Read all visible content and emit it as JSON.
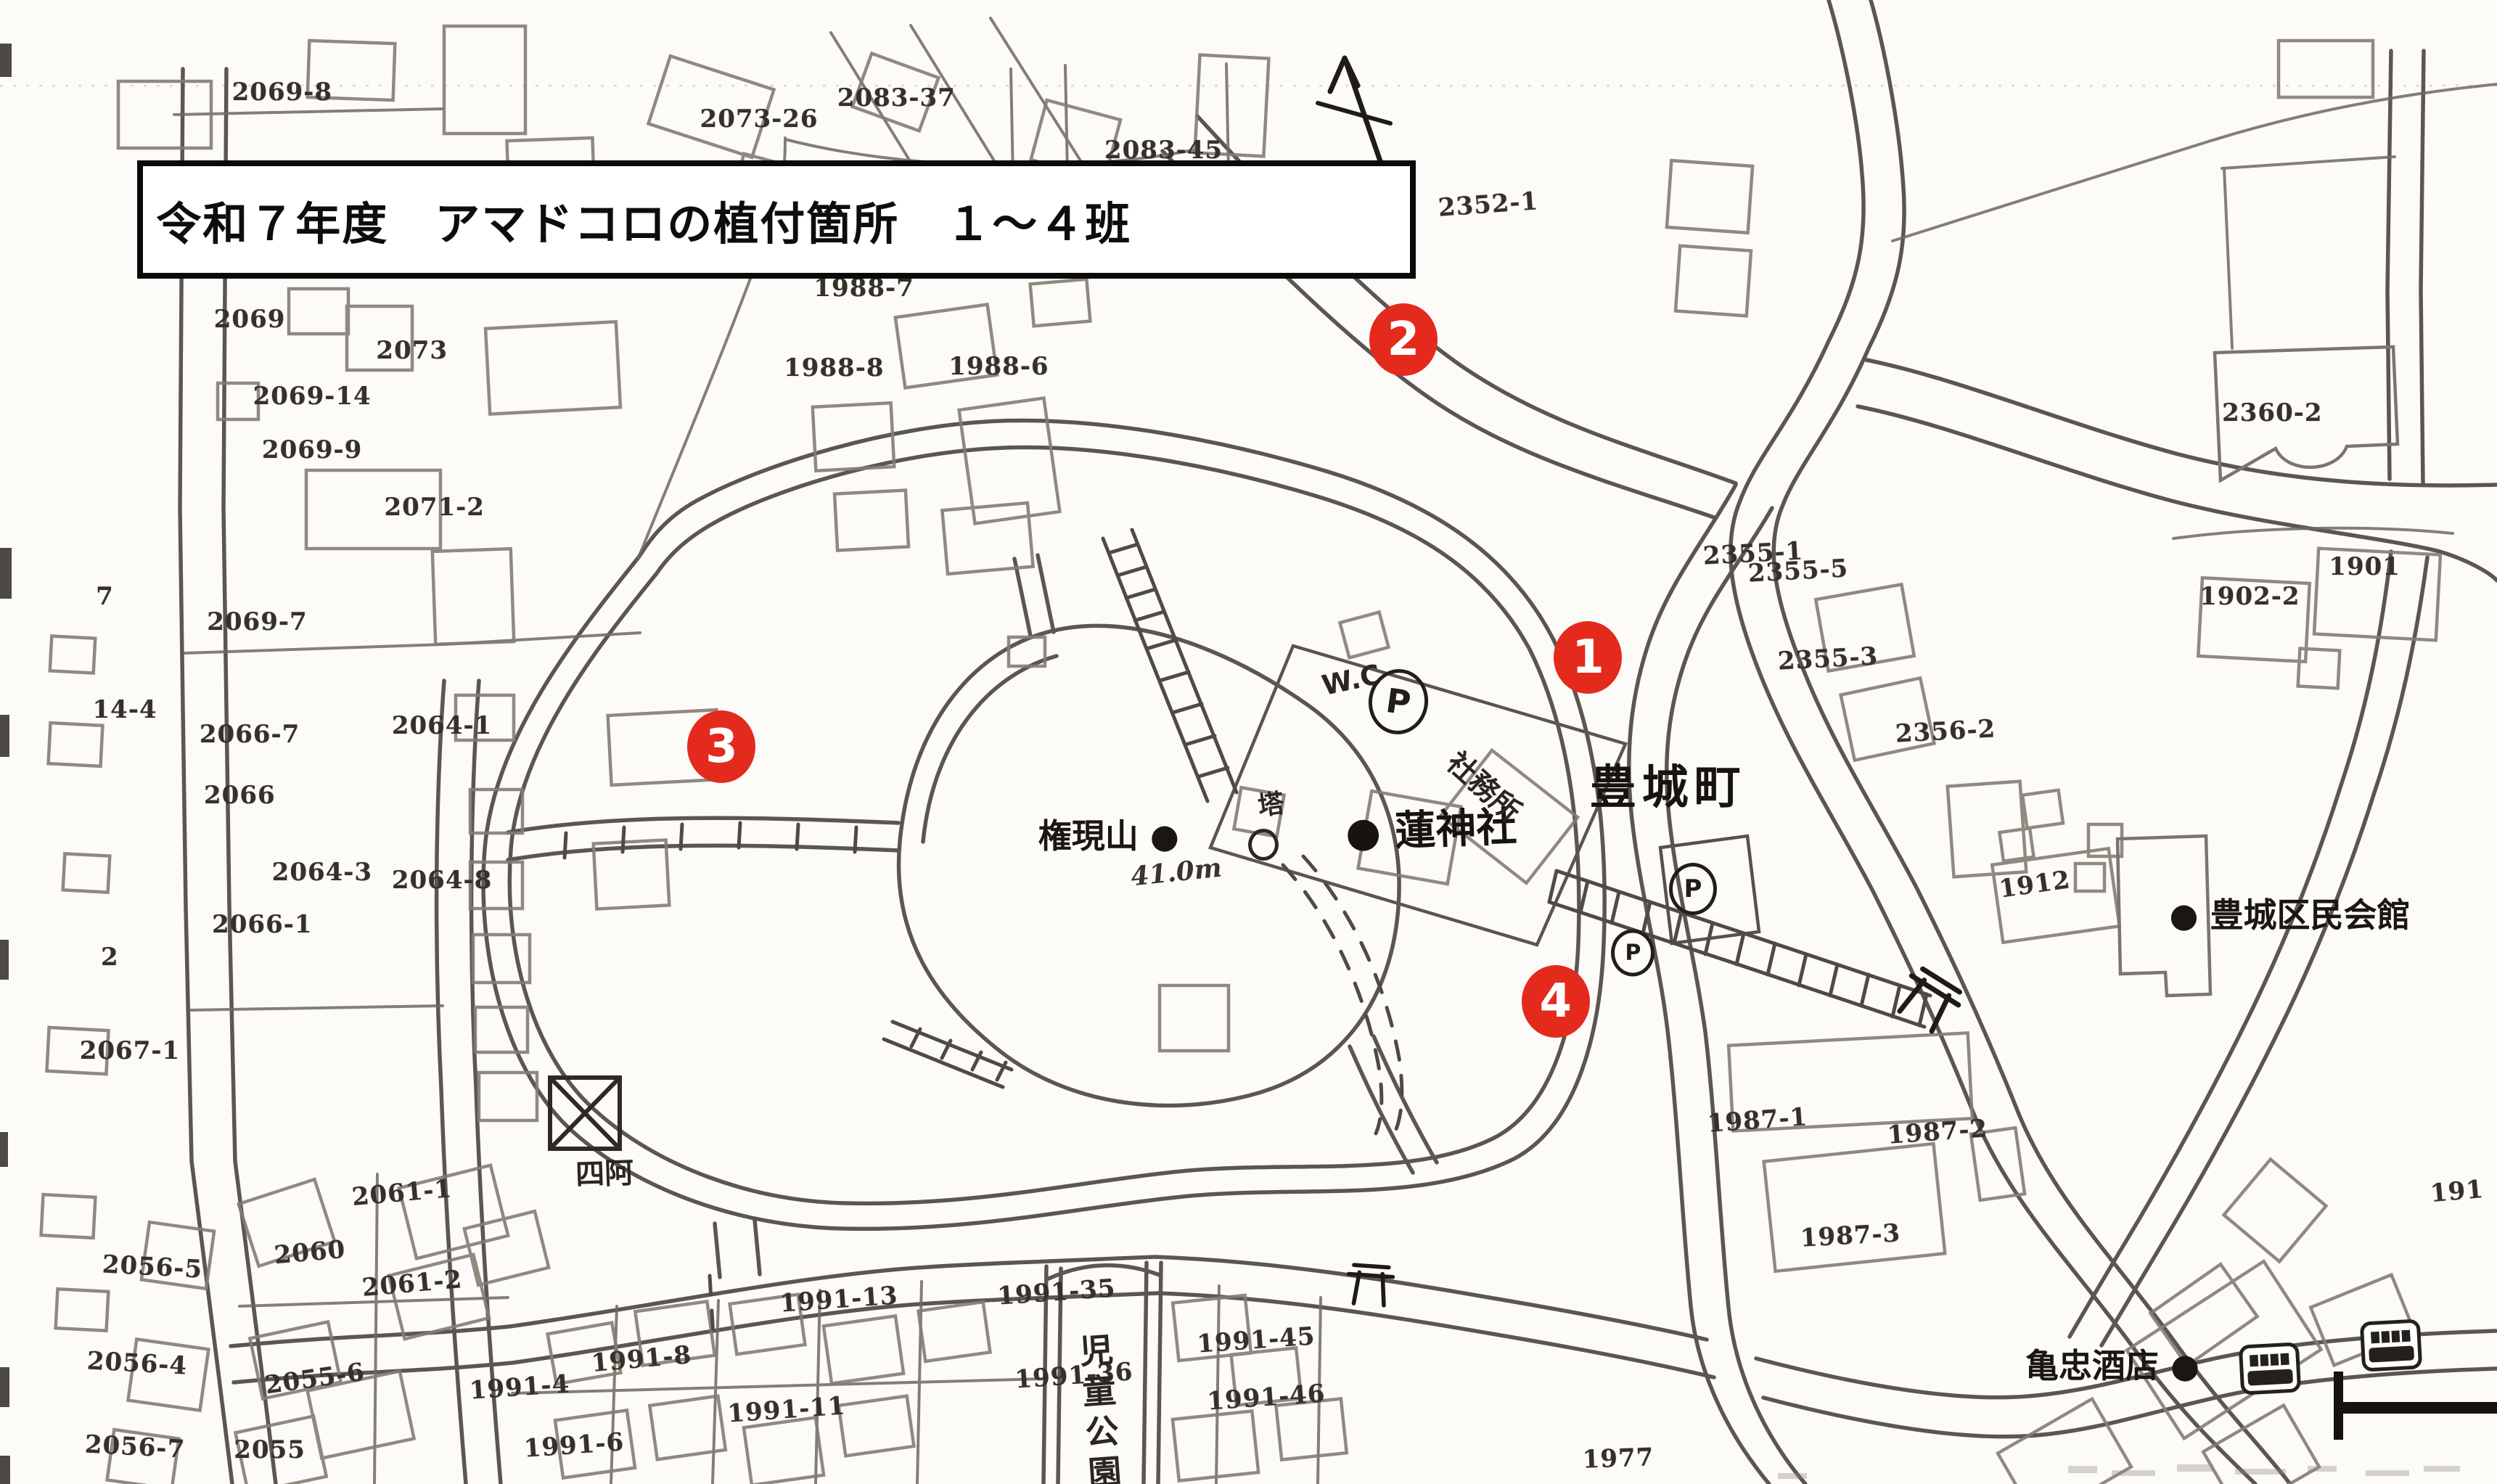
{
  "title": "令和７年度　アマドコロの植付箇所　１～４班",
  "marker_color": "#e32a1d",
  "markers": [
    {
      "label": "1",
      "x": 63.6,
      "y": 44.3
    },
    {
      "label": "2",
      "x": 56.2,
      "y": 22.9
    },
    {
      "label": "3",
      "x": 28.9,
      "y": 50.3
    },
    {
      "label": "4",
      "x": 62.3,
      "y": 67.5
    }
  ],
  "places": {
    "town": "豊城町",
    "mountain": "権現山 ●",
    "elevation": "41.0m",
    "shrine": "● 蓮神社",
    "shrine_office": "社務所",
    "wc": "W.C",
    "parking": "P",
    "tower": "塔",
    "gazebo": "四阿",
    "park": "児童公園",
    "community_hall": "● 豊城区民会館",
    "store": "亀忠酒店 ●"
  },
  "parcel_labels": [
    {
      "text": "2069-8",
      "x": 11.3,
      "y": 6.2
    },
    {
      "text": "2073-26",
      "x": 30.4,
      "y": 8.0
    },
    {
      "text": "2083-37",
      "x": 35.9,
      "y": 6.6
    },
    {
      "text": "2083-45",
      "x": 46.6,
      "y": 10.1
    },
    {
      "text": "2352-1",
      "x": 59.6,
      "y": 13.8,
      "rot": -4
    },
    {
      "text": "1988-7",
      "x": 34.6,
      "y": 19.4
    },
    {
      "text": "2069",
      "x": 10.0,
      "y": 21.5
    },
    {
      "text": "2073",
      "x": 16.5,
      "y": 23.6
    },
    {
      "text": "2069-14",
      "x": 12.5,
      "y": 26.7
    },
    {
      "text": "1988-8",
      "x": 33.4,
      "y": 24.8
    },
    {
      "text": "1988-6",
      "x": 40.0,
      "y": 24.7
    },
    {
      "text": "2069-9",
      "x": 12.5,
      "y": 30.3
    },
    {
      "text": "2355-1",
      "x": 70.2,
      "y": 37.3,
      "rot": -3
    },
    {
      "text": "2071-2",
      "x": 17.4,
      "y": 34.2
    },
    {
      "text": "2360-2",
      "x": 91.0,
      "y": 27.8
    },
    {
      "text": "2355-5",
      "x": 72.0,
      "y": 38.5,
      "rot": -3
    },
    {
      "text": "1901",
      "x": 94.7,
      "y": 38.2
    },
    {
      "text": "1902-2",
      "x": 90.1,
      "y": 40.2
    },
    {
      "text": "2069-7",
      "x": 10.3,
      "y": 41.9
    },
    {
      "text": "2355-3",
      "x": 73.2,
      "y": 44.4,
      "rot": -3
    },
    {
      "text": "7",
      "x": 4.2,
      "y": 40.2
    },
    {
      "text": "14-4",
      "x": 5.0,
      "y": 47.8
    },
    {
      "text": "2066-7",
      "x": 10.0,
      "y": 49.5
    },
    {
      "text": "2064-1",
      "x": 17.7,
      "y": 48.9
    },
    {
      "text": "2356-2",
      "x": 77.9,
      "y": 49.3,
      "rot": -3
    },
    {
      "text": "2066",
      "x": 9.6,
      "y": 53.6
    },
    {
      "text": "2064-3",
      "x": 12.9,
      "y": 58.8
    },
    {
      "text": "2064-8",
      "x": 17.7,
      "y": 59.3
    },
    {
      "text": "1912",
      "x": 81.5,
      "y": 59.6,
      "rot": -8
    },
    {
      "text": "2066-1",
      "x": 10.5,
      "y": 62.3
    },
    {
      "text": "2",
      "x": 4.4,
      "y": 64.5
    },
    {
      "text": "2067-1",
      "x": 5.2,
      "y": 70.8
    },
    {
      "text": "1987-1",
      "x": 70.4,
      "y": 75.5,
      "rot": -4
    },
    {
      "text": "1987-2",
      "x": 77.6,
      "y": 76.3,
      "rot": -4
    },
    {
      "text": "2061-1",
      "x": 16.1,
      "y": 80.4,
      "rot": -5
    },
    {
      "text": "191",
      "x": 98.4,
      "y": 80.3,
      "rot": -5
    },
    {
      "text": "1987-3",
      "x": 74.1,
      "y": 83.3,
      "rot": -3
    },
    {
      "text": "2056-5",
      "x": 6.1,
      "y": 85.4,
      "rot": 3
    },
    {
      "text": "2060",
      "x": 12.4,
      "y": 84.4,
      "rot": -5
    },
    {
      "text": "2061-2",
      "x": 16.5,
      "y": 86.5,
      "rot": -5
    },
    {
      "text": "1991-13",
      "x": 33.6,
      "y": 87.6,
      "rot": -4
    },
    {
      "text": "1991-35",
      "x": 42.3,
      "y": 87.1,
      "rot": -4
    },
    {
      "text": "1991-45",
      "x": 50.3,
      "y": 90.3,
      "rot": -4
    },
    {
      "text": "2056-4",
      "x": 5.5,
      "y": 91.9,
      "rot": 3
    },
    {
      "text": "1991-4",
      "x": 20.8,
      "y": 93.5,
      "rot": -4
    },
    {
      "text": "1991-8",
      "x": 25.7,
      "y": 91.6,
      "rot": -5
    },
    {
      "text": "1991-36",
      "x": 43.0,
      "y": 92.7,
      "rot": -4
    },
    {
      "text": "2055-6",
      "x": 12.6,
      "y": 92.9,
      "rot": -8
    },
    {
      "text": "1991-46",
      "x": 50.7,
      "y": 94.2,
      "rot": -4
    },
    {
      "text": "1991-11",
      "x": 31.5,
      "y": 95.0,
      "rot": -4
    },
    {
      "text": "2056-7",
      "x": 5.4,
      "y": 97.5,
      "rot": 3
    },
    {
      "text": "1991-6",
      "x": 23.0,
      "y": 97.4,
      "rot": -4
    },
    {
      "text": "2055",
      "x": 10.8,
      "y": 97.7
    },
    {
      "text": "1977",
      "x": 64.8,
      "y": 98.3,
      "rot": -2
    }
  ]
}
